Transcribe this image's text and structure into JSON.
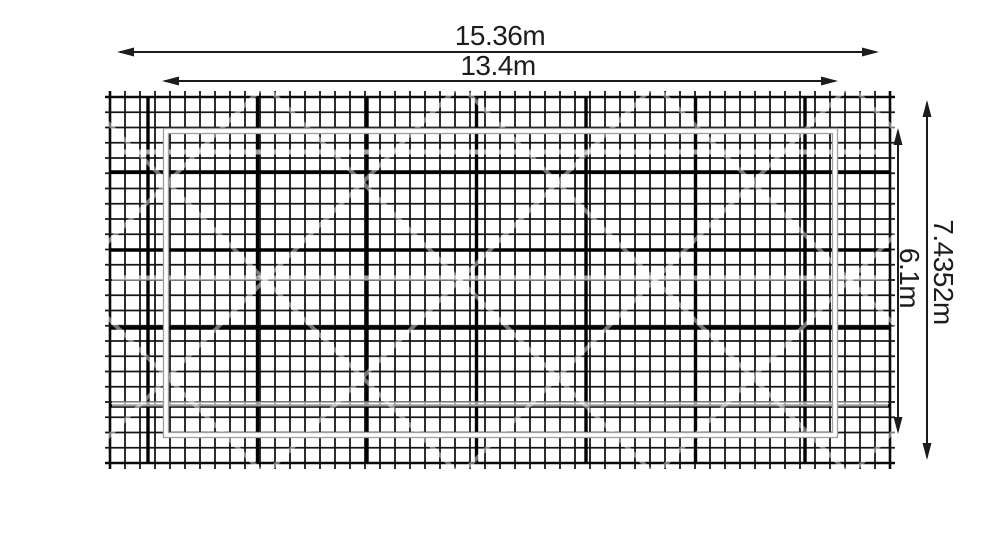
{
  "drawing": {
    "canvas": {
      "width": 1000,
      "height": 560,
      "background": "#ffffff"
    },
    "labels": {
      "outer_width": "15.36m",
      "inner_width": "13.4m",
      "outer_height": "7.4352m",
      "inner_height": "6.1m"
    },
    "measurements": {
      "outer_width_m": 15.36,
      "inner_width_m": 13.4,
      "outer_height_m": 7.4352,
      "inner_height_m": 6.1,
      "unit": "m"
    },
    "colors": {
      "grid_line": "#161616",
      "grid_border": "#0a0a0a",
      "major_line": "#000000",
      "inner_outline_gray": "#a0a0a0",
      "inner_outline_white": "#ffffff",
      "dimension_line": "#1c1c1c",
      "text": "#1c1c1c",
      "watermark_stripe": "rgba(255,255,255,0.62)",
      "watermark_diagonal": "rgba(255,255,255,0.45)"
    },
    "grid": {
      "x": 110,
      "y": 97,
      "cols": 52,
      "rows": 24,
      "pitch_x": 15,
      "pitch_y": 15.25,
      "tick_overhang": 6,
      "line_width": 1.8,
      "border_width": 2.6,
      "major_width": 3.4,
      "major_vertical_x": [
        148,
        257.5,
        367,
        476.5,
        586,
        695.5,
        805
      ],
      "major_horizontal_y": [
        172,
        250,
        328,
        406
      ],
      "stripe_y": [
        152,
        278,
        404
      ],
      "diagonal_spacing": 195
    },
    "inner_rect": {
      "x": 163,
      "y": 128,
      "w": 675,
      "h": 310
    },
    "dims": [
      {
        "name": "outer-width",
        "type": "h",
        "y": 52,
        "x1": 117,
        "x2": 879,
        "label_key": "outer_width"
      },
      {
        "name": "inner-width",
        "type": "h",
        "y": 81,
        "x1": 162,
        "x2": 838,
        "label_key": "inner_width"
      },
      {
        "name": "outer-height",
        "type": "v",
        "x": 927,
        "y1": 100,
        "y2": 460,
        "label_key": "outer_height"
      },
      {
        "name": "inner-height",
        "type": "v",
        "x": 898,
        "y1": 128,
        "y2": 434,
        "label_key": "inner_height"
      }
    ],
    "arrowhead": {
      "length": 17,
      "half_width": 4.5
    }
  }
}
